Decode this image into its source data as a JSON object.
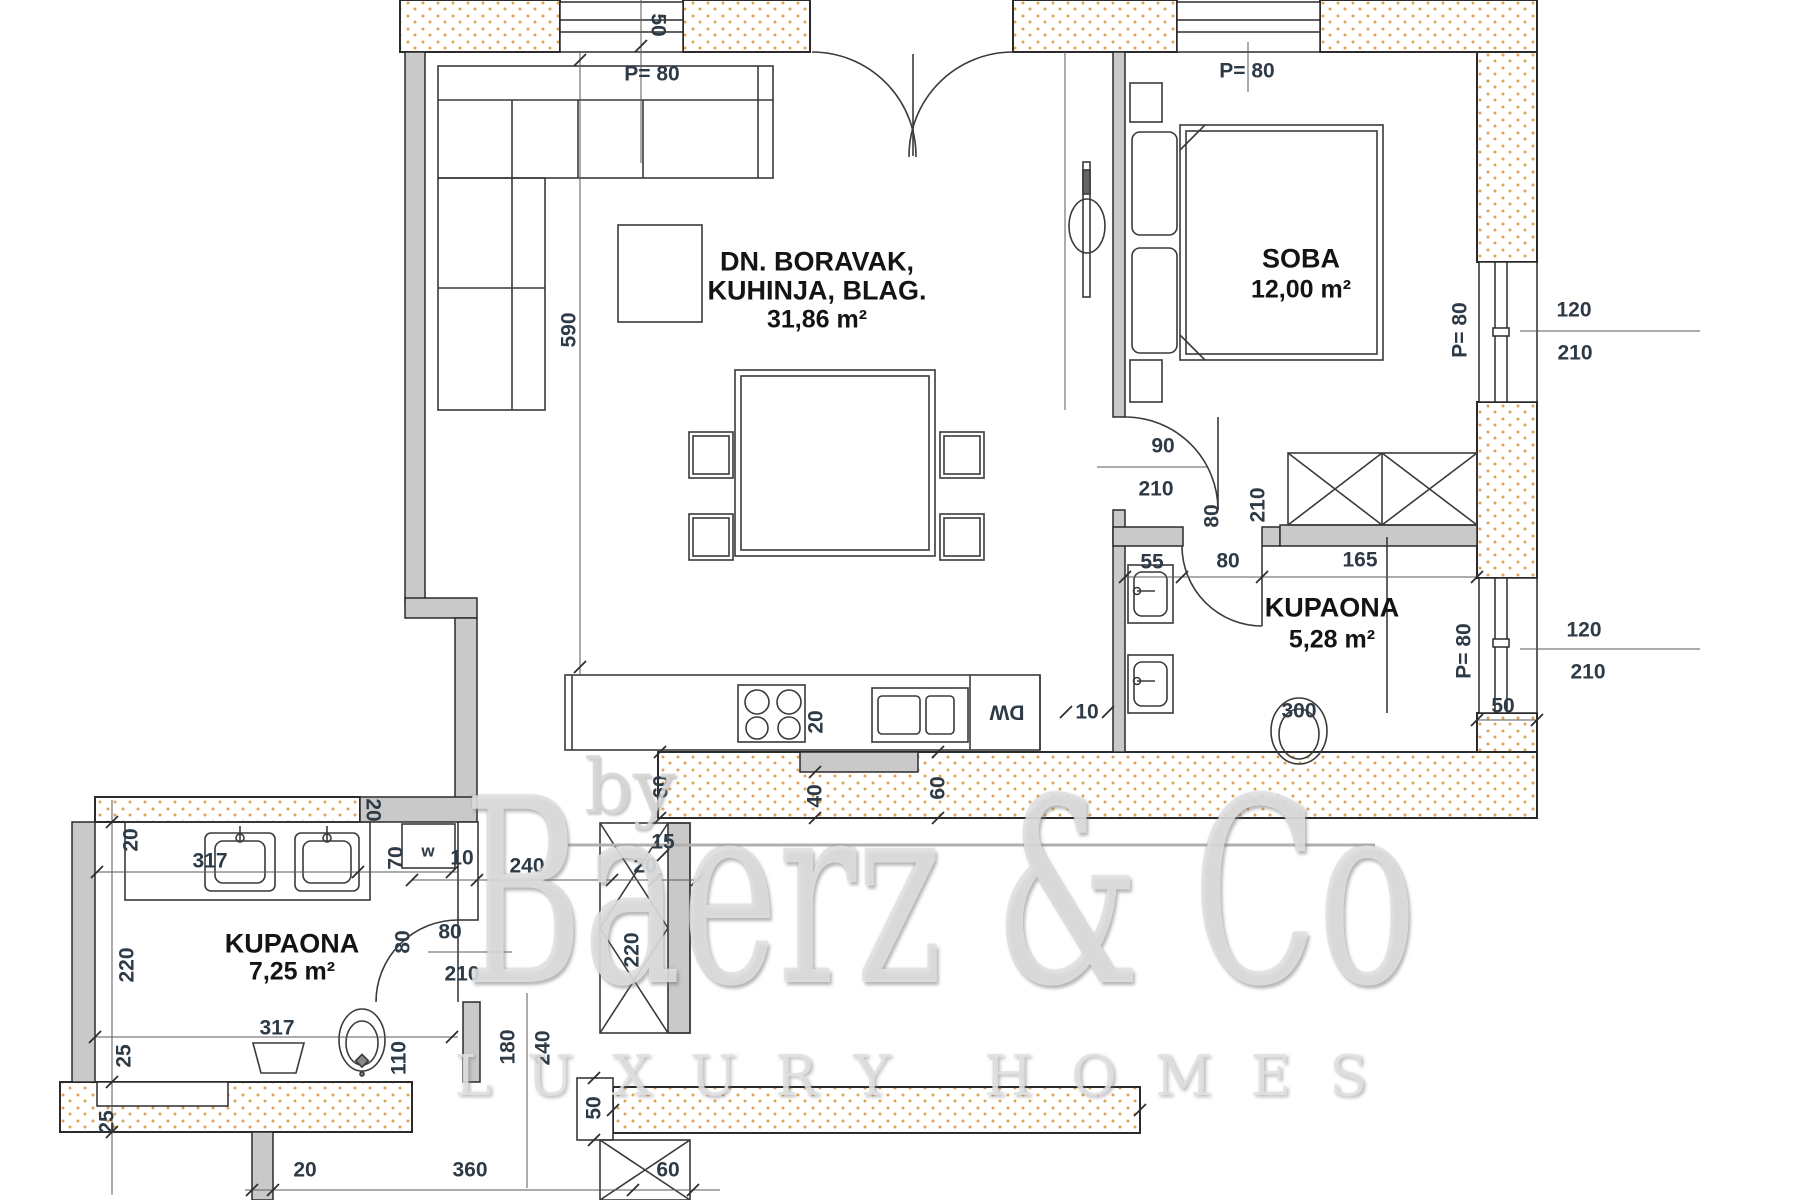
{
  "watermark": {
    "by": "by",
    "brand": "Baerz & Co",
    "tagline": "LUXURY HOMES"
  },
  "rooms": [
    {
      "id": "living",
      "x": 817,
      "y": 262,
      "lh": 29,
      "lines": [
        "DN. BORAVAK,",
        "KUHINJA, BLAG.",
        "31,86 m²"
      ]
    },
    {
      "id": "bedroom",
      "x": 1301,
      "y": 259,
      "lh": 31,
      "lines": [
        "SOBA",
        "12,00 m²"
      ]
    },
    {
      "id": "bath-1",
      "x": 1332,
      "y": 608,
      "lh": 32,
      "lines": [
        "KUPAONA",
        "5,28 m²"
      ]
    },
    {
      "id": "bath-2",
      "x": 292,
      "y": 944,
      "lh": 28,
      "lines": [
        "KUPAONA",
        "7,25 m²"
      ]
    }
  ],
  "dim_labels": [
    {
      "t": "50",
      "x": 658,
      "y": 25,
      "r": 90
    },
    {
      "t": "P= 80",
      "x": 652,
      "y": 74,
      "r": 0
    },
    {
      "t": "P= 80",
      "x": 1247,
      "y": 71,
      "r": 0
    },
    {
      "t": "590",
      "x": 569,
      "y": 330,
      "r": -90
    },
    {
      "t": "90",
      "x": 1163,
      "y": 446,
      "r": 0
    },
    {
      "t": "210",
      "x": 1156,
      "y": 489,
      "r": 0
    },
    {
      "t": "80",
      "x": 1212,
      "y": 516,
      "r": -90
    },
    {
      "t": "210",
      "x": 1258,
      "y": 505,
      "r": -90
    },
    {
      "t": "55",
      "x": 1152,
      "y": 562,
      "r": 0
    },
    {
      "t": "80",
      "x": 1228,
      "y": 561,
      "r": 0
    },
    {
      "t": "165",
      "x": 1360,
      "y": 560,
      "r": 0
    },
    {
      "t": "P= 80",
      "x": 1460,
      "y": 330,
      "r": -90
    },
    {
      "t": "120",
      "x": 1574,
      "y": 310,
      "r": 0
    },
    {
      "t": "210",
      "x": 1575,
      "y": 353,
      "r": 0
    },
    {
      "t": "P= 80",
      "x": 1464,
      "y": 651,
      "r": -90
    },
    {
      "t": "120",
      "x": 1584,
      "y": 630,
      "r": 0
    },
    {
      "t": "210",
      "x": 1588,
      "y": 672,
      "r": 0
    },
    {
      "t": "50",
      "x": 1503,
      "y": 706,
      "r": 0
    },
    {
      "t": "300",
      "x": 1299,
      "y": 711,
      "r": 0
    },
    {
      "t": "20",
      "x": 816,
      "y": 722,
      "r": -90
    },
    {
      "t": "60",
      "x": 661,
      "y": 787,
      "r": -90
    },
    {
      "t": "40",
      "x": 815,
      "y": 796,
      "r": -90
    },
    {
      "t": "60",
      "x": 938,
      "y": 788,
      "r": -90
    },
    {
      "t": "10",
      "x": 1087,
      "y": 712,
      "r": 0
    },
    {
      "t": "15",
      "x": 663,
      "y": 842,
      "r": 0
    },
    {
      "t": "240",
      "x": 527,
      "y": 866,
      "r": 0
    },
    {
      "t": "20",
      "x": 645,
      "y": 866,
      "r": 0
    },
    {
      "t": "220",
      "x": 632,
      "y": 950,
      "r": -90
    },
    {
      "t": "50",
      "x": 594,
      "y": 1108,
      "r": -90
    },
    {
      "t": "180",
      "x": 508,
      "y": 1047,
      "r": -90
    },
    {
      "t": "240",
      "x": 543,
      "y": 1048,
      "r": -90
    },
    {
      "t": "20",
      "x": 305,
      "y": 1170,
      "r": 0
    },
    {
      "t": "360",
      "x": 470,
      "y": 1170,
      "r": 0
    },
    {
      "t": "60",
      "x": 668,
      "y": 1170,
      "r": 0
    },
    {
      "t": "20",
      "x": 373,
      "y": 810,
      "r": 90
    },
    {
      "t": "70",
      "x": 396,
      "y": 858,
      "r": -90
    },
    {
      "t": "w",
      "x": 428,
      "y": 851,
      "r": 0,
      "s": 17
    },
    {
      "t": "10",
      "x": 462,
      "y": 858,
      "r": 0
    },
    {
      "t": "80",
      "x": 403,
      "y": 942,
      "r": -90
    },
    {
      "t": "80",
      "x": 450,
      "y": 932,
      "r": 0
    },
    {
      "t": "210",
      "x": 462,
      "y": 974,
      "r": 0
    },
    {
      "t": "20",
      "x": 131,
      "y": 840,
      "r": -90
    },
    {
      "t": "220",
      "x": 127,
      "y": 965,
      "r": -90
    },
    {
      "t": "317",
      "x": 210,
      "y": 861,
      "r": 0
    },
    {
      "t": "317",
      "x": 277,
      "y": 1028,
      "r": 0
    },
    {
      "t": "25",
      "x": 124,
      "y": 1056,
      "r": -90
    },
    {
      "t": "25",
      "x": 107,
      "y": 1122,
      "r": -90
    },
    {
      "t": "110",
      "x": 399,
      "y": 1058,
      "r": -90
    },
    {
      "t": "DW",
      "x": 1007,
      "y": 712,
      "r": 180
    }
  ],
  "colors": {
    "wall_dot": "#dd9944",
    "wall_gray": "#c9c9c9",
    "line": "#2e2e2e",
    "dim_text": "#2e3b46"
  }
}
